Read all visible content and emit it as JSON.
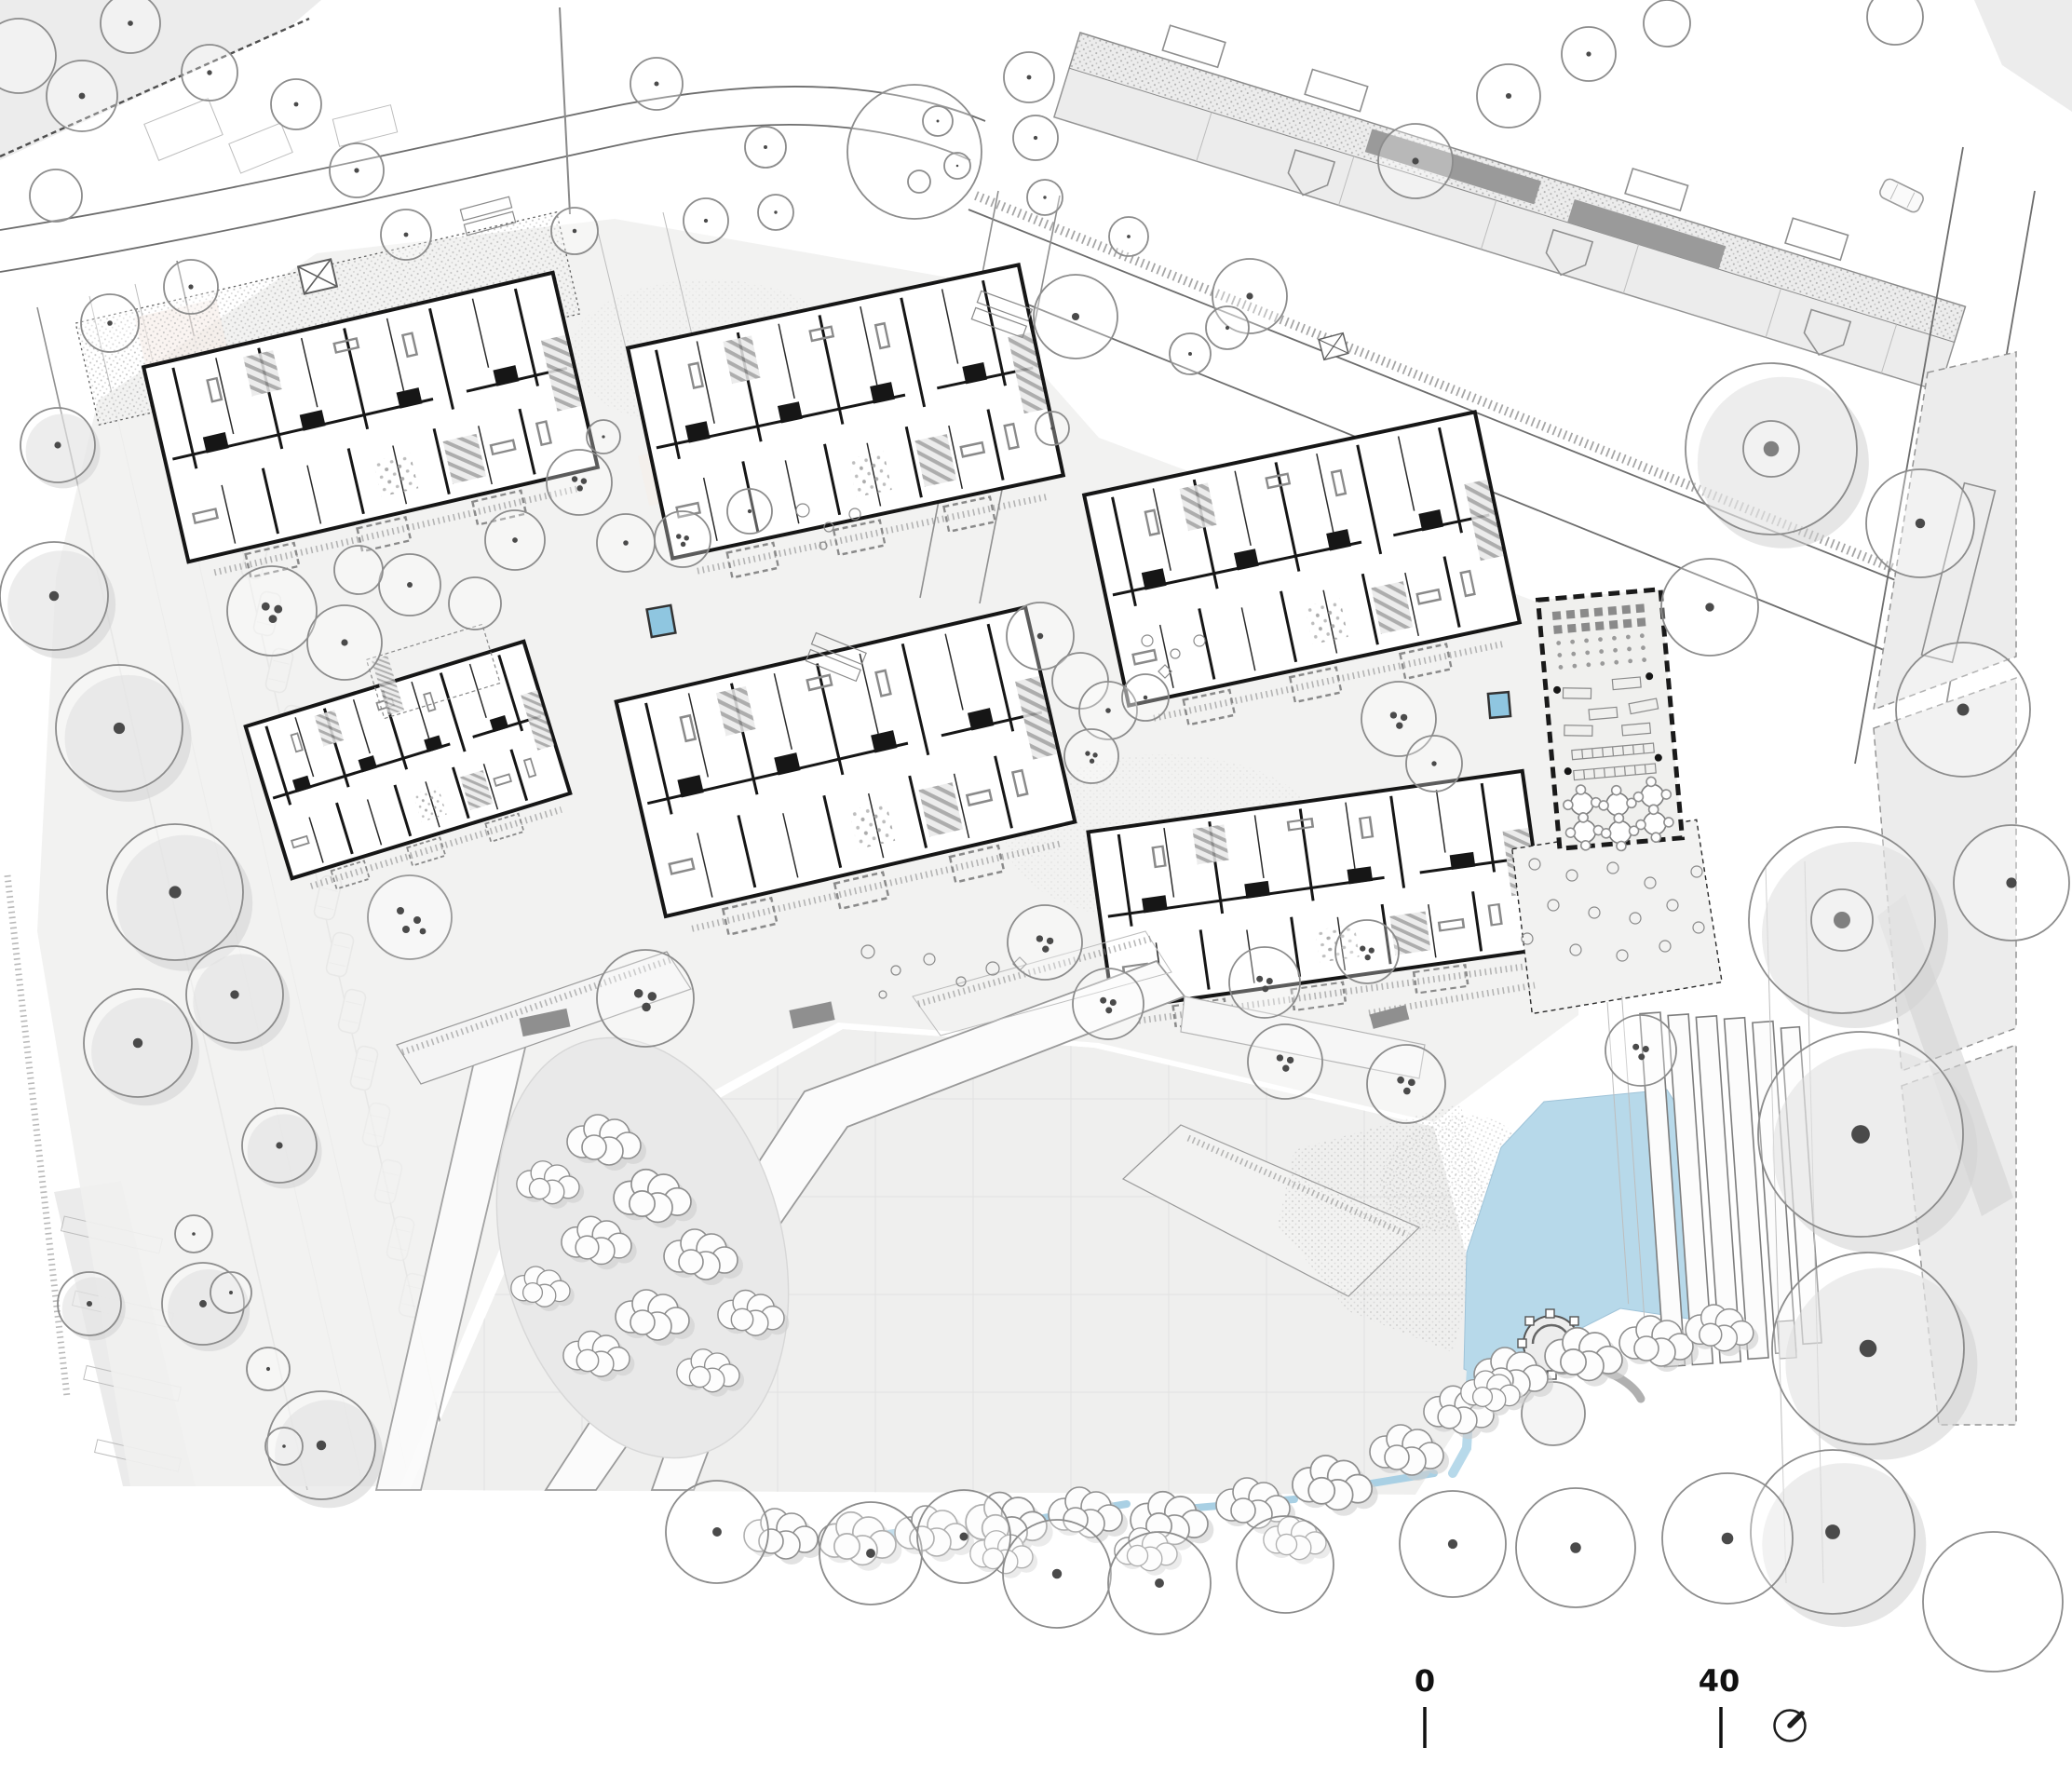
{
  "scale_bar": {
    "start_label": "0",
    "end_label": "40"
  },
  "icons": {
    "north_arrow": "north-arrow-icon"
  },
  "colors": {
    "paper": "#ffffff",
    "plaza": "#f1f1f0",
    "plaza_lower": "#efefee",
    "context": "#ececec",
    "context_roof": "#9a9a9a",
    "water": "#b7d9ea",
    "creek": "#a9d0e4",
    "play_water": "#8fc6e0",
    "walls": "#161616",
    "tree_outline": "#8c8c8c",
    "shadow": "#d2d2d2",
    "bench": "#8f8f8f"
  }
}
